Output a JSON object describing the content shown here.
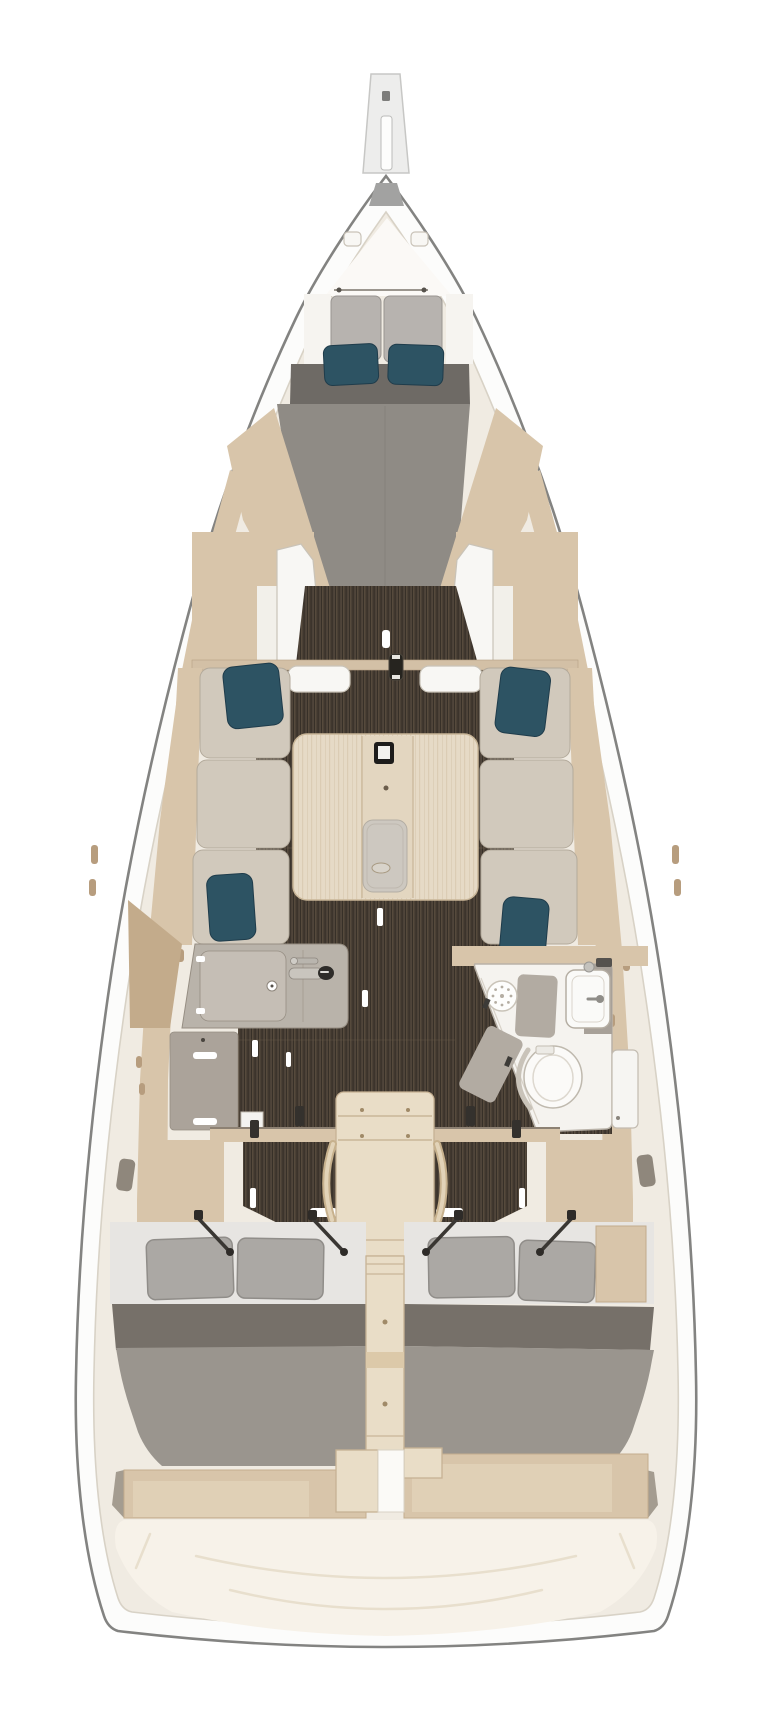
{
  "figure": {
    "type": "sailboat-interior-floor-plan",
    "view": "top-down",
    "orientation": "bow-up"
  },
  "palette": {
    "hull_outline": "#838381",
    "hull_white": "#fcfcfb",
    "hull_cap": "#a2a2a1",
    "liner_cream": "#f0ebe2",
    "liner_line": "#d8d2c6",
    "wood_tan": "#d8c5aa",
    "wood_tan_dark": "#c3ab8b",
    "wood_tan_light": "#e0d0b6",
    "floor_brown": "#463d33",
    "floor_stripe_light": "#564a3c",
    "floor_stripe_dark": "#352e27",
    "counter_gray": "#b9b3aa",
    "counter_light": "#c5beb5",
    "counter_line": "#968e83",
    "cabinet_gray": "#aba39a",
    "cushion_beige": "#d1c9bc",
    "cushion_line": "#b3aa9b",
    "headrest_gray": "#b7b3af",
    "headrest_line": "#989490",
    "mattress_gray": "#8f8b85",
    "mattress_dark": "#6e6a65",
    "blanket_gray": "#9a958e",
    "aft_band_dark": "#767069",
    "sheet_light": "#e7e5e2",
    "pillow_teal": "#2d5363",
    "pillow_teal_dark": "#1f3c4b",
    "pillow_gray": "#aba8a4",
    "pillow_gray_line": "#908d89",
    "table_wood": "#e6dac6",
    "table_line": "#c9b698",
    "steps_wood": "#e9ddc7",
    "steps_line": "#c7b294",
    "metal_dark": "#34312d",
    "slot_brown": "#b79d7e",
    "seam": "#e8dfcd",
    "soft_line": "#c9c3b8",
    "transom_cream": "#f7f2e9",
    "white_fixture": "#f8f7f4"
  },
  "rooms": {
    "bowsprit": "Bowsprit",
    "forward_cabin": "Forward cabin with V-berth and two teal pillows",
    "salon": "Salon with port and starboard settees and folding table",
    "galley": "Port galley with sink, faucet and lower cabinet",
    "head": "Starboard head with shower drain, wash basin and toilet",
    "companionway": "Companionway steps with handrails",
    "aft_cabin_port": "Port aft double cabin with two pillows",
    "aft_cabin_starboard": "Starboard aft double cabin with two pillows",
    "stern": "Stern lockers and transom deck"
  },
  "furnishings": [
    "v-berth-mattress",
    "headrest-cushions",
    "teal-pillows-x6",
    "salon-table",
    "table-lamp",
    "table-tray",
    "mast-post",
    "galley-counter",
    "galley-sink-faucet",
    "galley-cabinet",
    "shower-drain",
    "wash-basin",
    "toilet",
    "head-door",
    "companionway-steps",
    "berth-lift-struts-x4",
    "gray-pillows-x4",
    "aft-berths",
    "stern-lockers"
  ]
}
